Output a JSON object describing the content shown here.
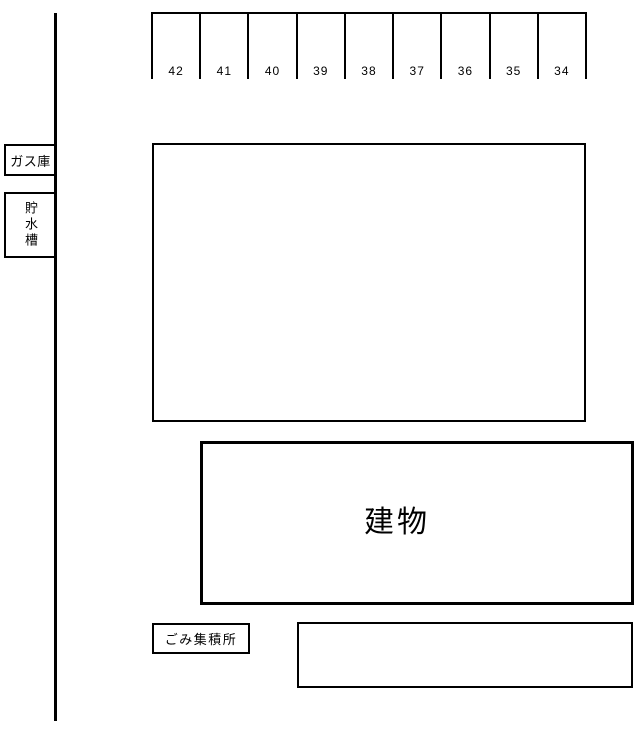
{
  "parking_row": {
    "stalls": [
      "42",
      "41",
      "40",
      "39",
      "38",
      "37",
      "36",
      "35",
      "34"
    ]
  },
  "gas_box": {
    "label": "ガス庫"
  },
  "water_tank_box": {
    "label": "貯水槽"
  },
  "building": {
    "label": "建物"
  },
  "garbage_box": {
    "label": "ごみ集積所"
  },
  "colors": {
    "line": "#000000",
    "background": "#ffffff"
  }
}
